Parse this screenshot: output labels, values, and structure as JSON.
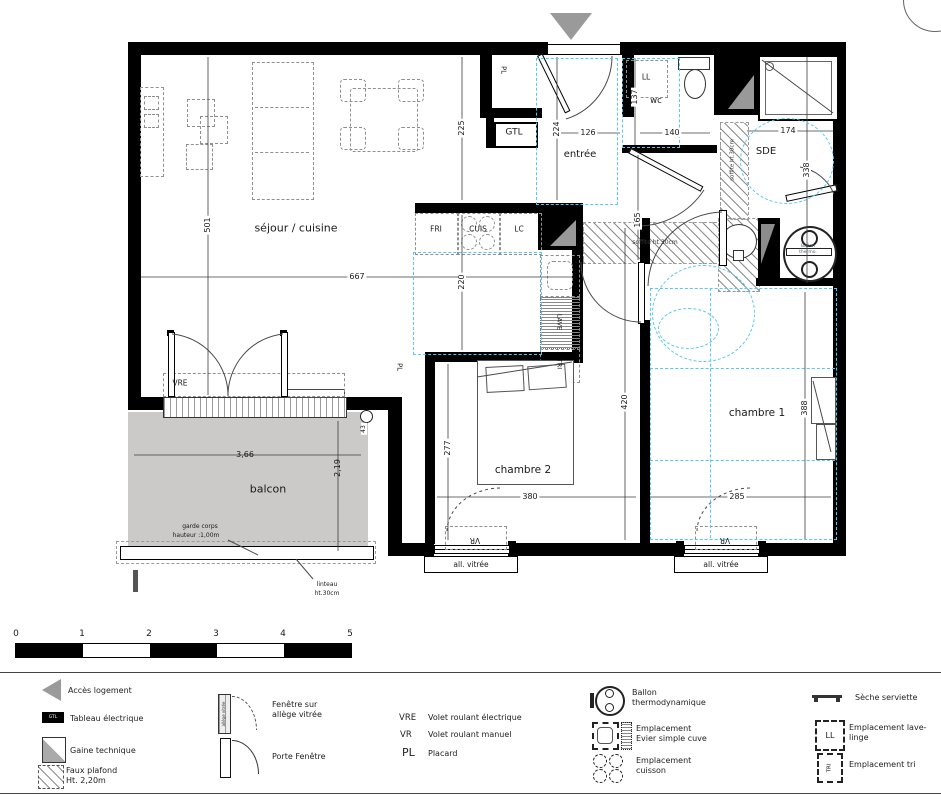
{
  "plan": {
    "rooms": {
      "sejour": "séjour / cuisine",
      "entree": "entrée",
      "wc": "wc",
      "sde": "SDE",
      "chambre1": "chambre 1",
      "chambre2": "chambre 2",
      "balcon": "balcon"
    },
    "fixtures": {
      "gtl": "GTL",
      "pl": "PL",
      "ll": "LL",
      "fri": "FRI",
      "cuis": "CUIS",
      "lc": "LC",
      "lave": "LAVE",
      "tri": "TRI",
      "vre": "VRE",
      "vr": "VR"
    },
    "dims": {
      "d501": "501",
      "d667": "667",
      "d225": "225",
      "d220": "220",
      "d224": "224",
      "d126": "126",
      "d137": "137",
      "d140": "140",
      "d174": "174",
      "d338": "338",
      "d165": "165",
      "d420": "420",
      "d277": "277",
      "d380": "380",
      "d388": "388",
      "d285": "285",
      "d43": "43"
    },
    "balcony": {
      "width": "3,66",
      "depth": "2,19",
      "garde1": "garde corps",
      "garde2": "hauteur :1,00m",
      "linteau1": "linteau",
      "linteau2": "ht.30cm"
    },
    "notes": {
      "soffite": "soffite ht.30cm",
      "all_vitree": "all. vitrée",
      "ballon1": "Ballon",
      "ballon2": "thermo."
    }
  },
  "scalebar": {
    "ticks": [
      "0",
      "1",
      "2",
      "3",
      "4",
      "5"
    ]
  },
  "legend": {
    "acces": "Accès  logement",
    "tableau": "Tableau électrique",
    "tableau_icon": "GTL",
    "gaine": "Gaine technique",
    "faux1": "Faux plafond",
    "faux2": "Ht. 2,20m",
    "fenetre1": "Fenêtre sur",
    "fenetre2": "allège vitrée",
    "allege_icon": "allège vitrée",
    "porte": "Porte Fenêtre",
    "vre_key": "VRE",
    "vre_val": "Volet roulant électrique",
    "vr_key": "VR",
    "vr_val": "Volet roulant manuel",
    "pl_key": "PL",
    "pl_val": "Placard",
    "ballon1": "Ballon",
    "ballon2": "thermodynamique",
    "evier1": "Emplacement",
    "evier2": "Evier simple cuve",
    "cuisson1": "Emplacement",
    "cuisson2": "cuisson",
    "seche": "Sèche serviette",
    "lave1": "Emplacement lave-",
    "lave2": "linge",
    "ll_icon": "LL",
    "tri_label": "Emplacement tri",
    "tri_icon": "TRI"
  },
  "colors": {
    "accent_blue": "#56c7f0",
    "balcony_gray": "#cbcac8",
    "wall": "#000000"
  }
}
